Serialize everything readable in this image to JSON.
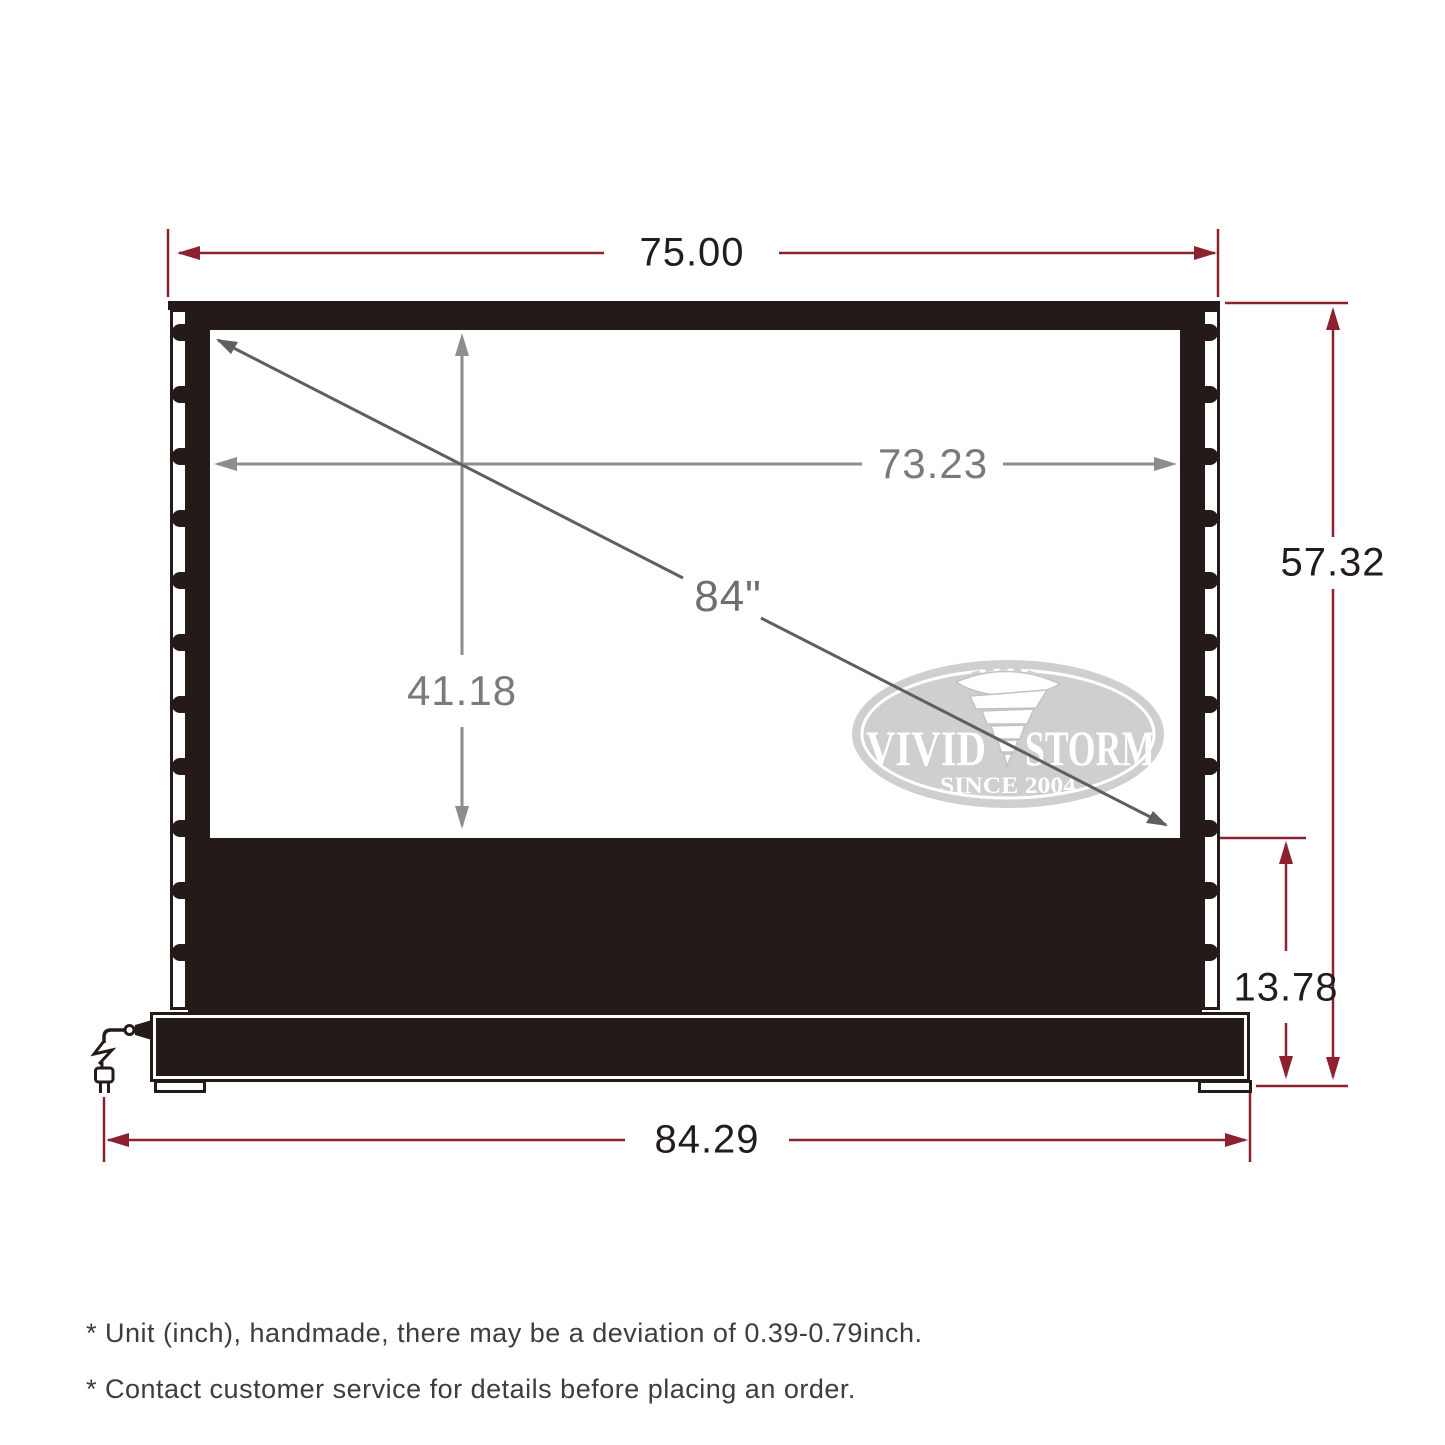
{
  "diagram": {
    "dimensions": {
      "top_width": "75.00",
      "viewable_width": "73.23",
      "viewable_height": "41.18",
      "diagonal": "84\"",
      "total_height": "57.32",
      "base_height": "13.78",
      "base_width": "84.29"
    },
    "logo": {
      "word_left": "VIVID",
      "word_right": "STORM",
      "tagline": "SINCE 2004"
    },
    "notes": [
      "* Unit (inch), handmade, there may be a deviation of 0.39-0.79inch.",
      "* Contact customer service for details before placing an order."
    ],
    "colors": {
      "dimension_red": "#8e2130",
      "ink": "#221d1b",
      "screen_black": "#241b18",
      "gray_line": "#8d8d8d",
      "gray_text": "#7a7a7a",
      "logo_gray": "#cfcfcf"
    }
  }
}
